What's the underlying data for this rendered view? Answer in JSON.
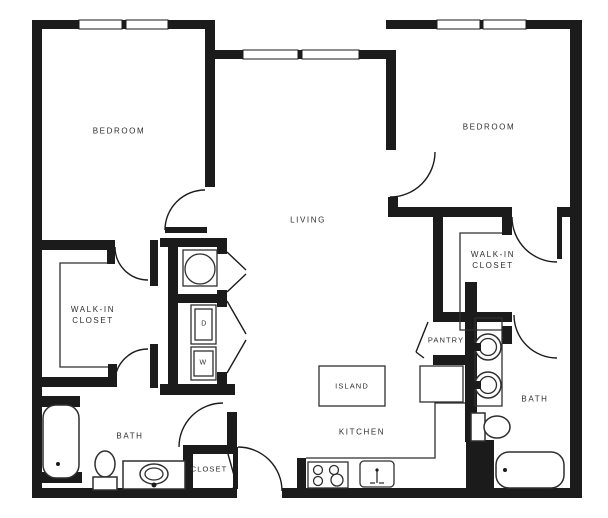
{
  "plan_title": "Two bedroom, two bath apartment floor plan",
  "colors": {
    "wall": "#1b1b1b",
    "fixture_line": "#2f2f2f",
    "text": "#2e2e2e",
    "background": "#ffffff"
  },
  "rooms": {
    "bedroom_1": "BEDROOM",
    "bedroom_2": "BEDROOM",
    "living": "LIVING",
    "kitchen": "KITCHEN",
    "island": "ISLAND",
    "pantry": "PANTRY",
    "bath_1": "BATH",
    "bath_2": "BATH",
    "closet": "CLOSET",
    "walk_in_closet_1": {
      "line1": "WALK-IN",
      "line2": "CLOSET"
    },
    "walk_in_closet_2": {
      "line1": "WALK-IN",
      "line2": "CLOSET"
    }
  },
  "appliances": {
    "dryer": "D",
    "washer": "W"
  },
  "fixtures": [
    "bathtub-icon",
    "toilet-icon",
    "vanity-sink-icon",
    "water-heater-icon",
    "dryer-unit-icon",
    "washer-unit-icon",
    "kitchen-island-icon",
    "range-stove-icon",
    "kitchen-sink-icon",
    "refrigerator-icon",
    "double-sink-vanity-icon",
    "window-icon",
    "door-swing-icon"
  ]
}
